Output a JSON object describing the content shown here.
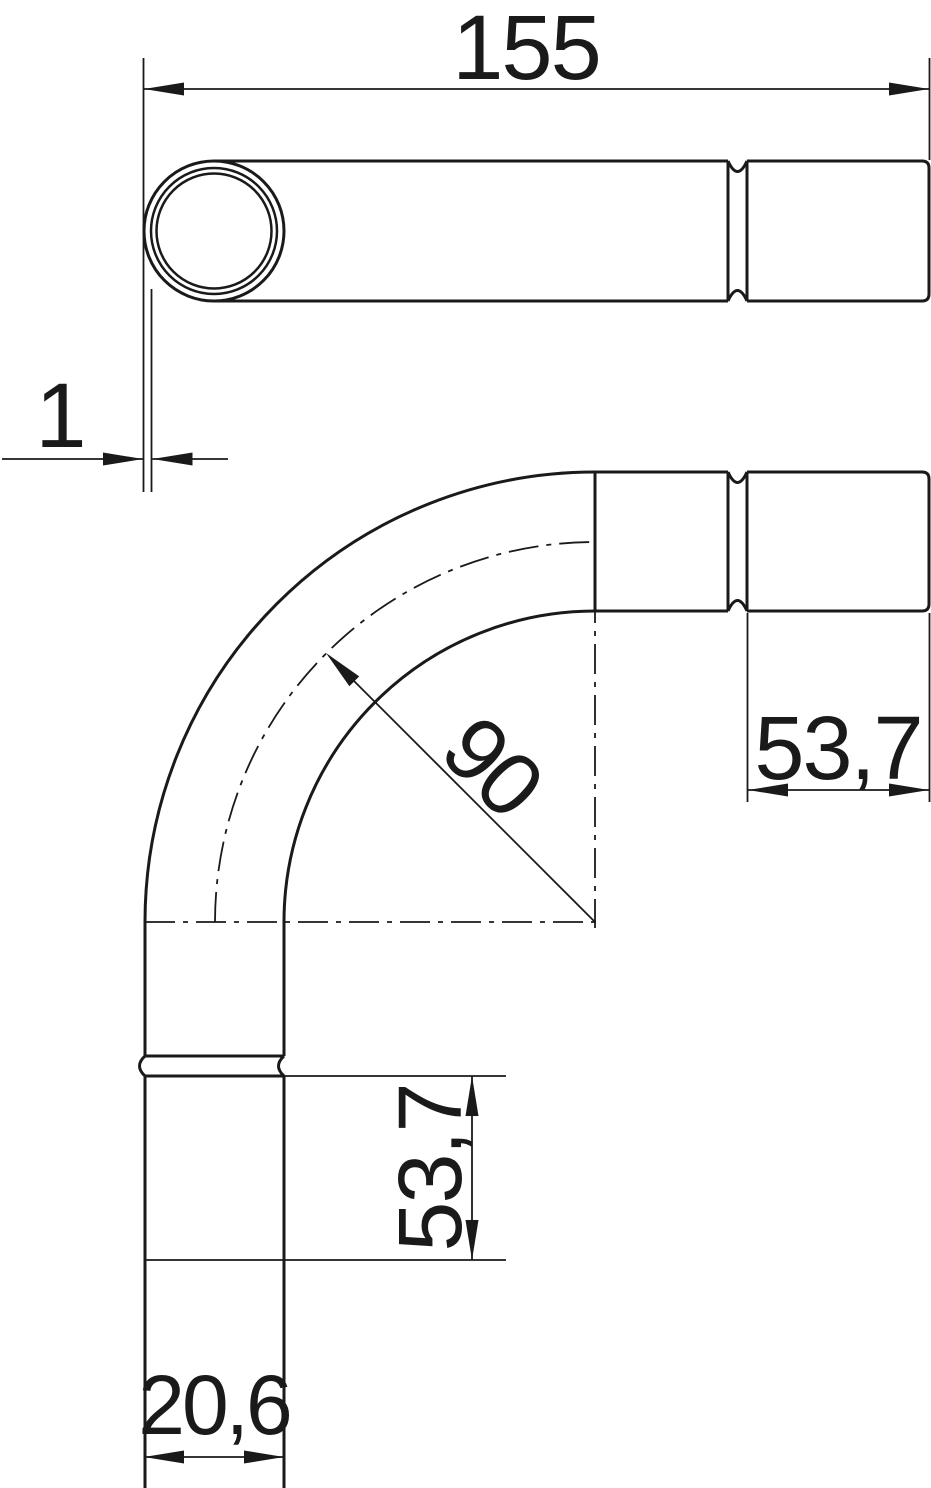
{
  "drawing": {
    "background_color": "#ffffff",
    "line_color": "#1a1a1a",
    "dimensions": {
      "overall_length": "155",
      "wall_thickness": "1",
      "bend_radius": "90",
      "socket_depth_right": "53,7",
      "socket_depth_bottom": "53,7",
      "outer_diameter": "20,6"
    }
  }
}
